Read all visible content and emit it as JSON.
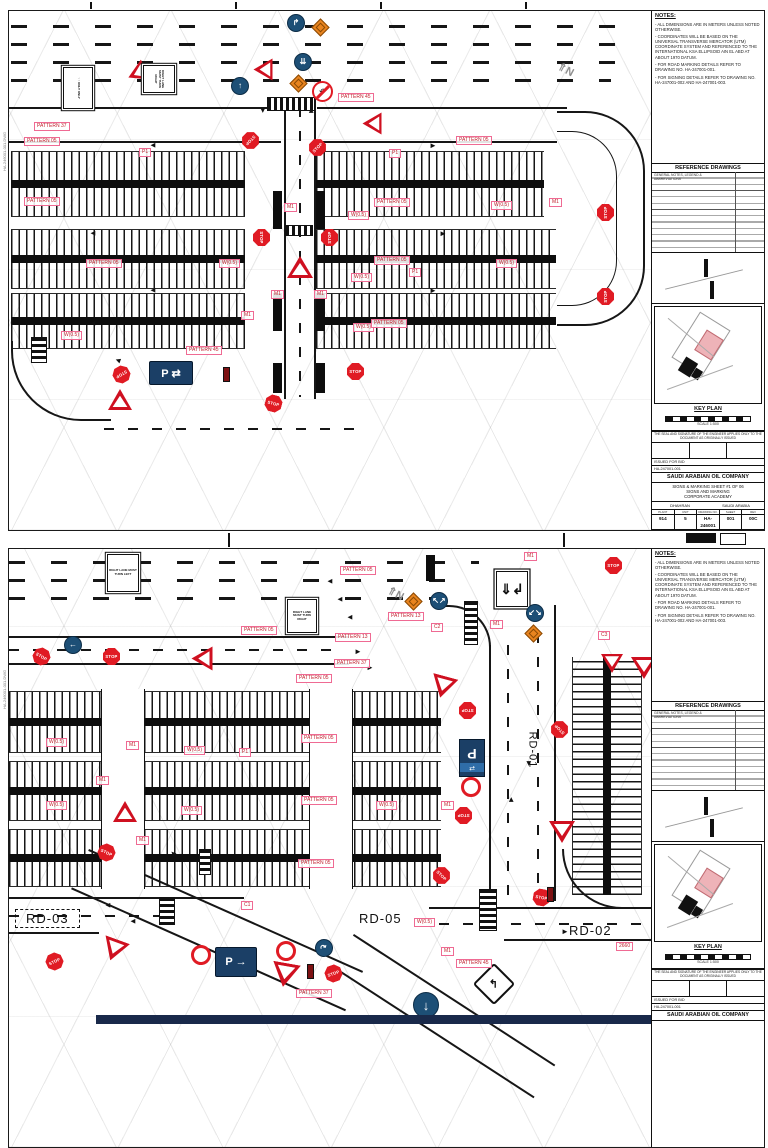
{
  "tb": {
    "notes_title": "NOTES:",
    "notes": [
      "ALL DIMENSIONS ARE IN METERS UNLESS NOTED OTHERWISE.",
      "COORDINATES WILL BE BASED ON THE UNIVERSAL TRANSVERSE MERCATOR (UTM) COORDINATE SYSTEM AND REFERENCED TO THE INTERNATIONAL KSA ELLIPSOID AIN EL ABD AT ABOUT 1970 DATUM.",
      "FOR ROAD MARKING DETAILS REFER TO DRAWING NO. HA-247001-001.",
      "FOR SIGNING DETAILS REFER TO DRAWING NO. HA-247001-002 AND HA-247001-003."
    ],
    "reference_title": "REFERENCE DRAWINGS",
    "ref_row1": "GENERAL NOTES, LEGEND & ABBREVIATIONS",
    "key_plan_label": "KEY PLAN",
    "scale_caption": "SCALE 1:500",
    "cert_note": "THE SEAL AND SIGNATURE OF THE ENGINEER APPLIES ONLY TO THE DOCUMENT AS ORIGINALLY ISSUED",
    "issue_row": "ISSUED FOR BID",
    "job_no": "HA-247001-001",
    "company": "SAUDI ARABIAN OIL COMPANY",
    "title1": "SIGNS & MARKING SHEET #1 OF 06",
    "title2": "SIGNS AND MARKING",
    "title3": "CORPORATE ACADEMY",
    "loc1": "DHAHRAN",
    "loc2": "SAUDI ARABIA",
    "num_labels": [
      "PLANT",
      "UNIT",
      "DRAWING NO.",
      "SHEET",
      "REV"
    ],
    "num_row": [
      "914",
      "5",
      "HA-246001",
      "001",
      "00C"
    ],
    "margin_text": "HA-246001-001.DWG"
  },
  "sheets": [
    {
      "labels": [
        {
          "t": "PATTERN 37",
          "x": 25,
          "y": 111
        },
        {
          "t": "PATTERN 05",
          "x": 15,
          "y": 126
        },
        {
          "t": "P1",
          "x": 130,
          "y": 137
        },
        {
          "t": "PATTERN 05",
          "x": 447,
          "y": 125
        },
        {
          "t": "P1",
          "x": 380,
          "y": 138
        },
        {
          "t": "PATTERN 05",
          "x": 15,
          "y": 186
        },
        {
          "t": "PATTERN 05",
          "x": 365,
          "y": 187
        },
        {
          "t": "W(0.5)",
          "x": 339,
          "y": 200
        },
        {
          "t": "W(0.5)",
          "x": 482,
          "y": 190
        },
        {
          "t": "M1",
          "x": 275,
          "y": 192
        },
        {
          "t": "W(0.5)",
          "x": 210,
          "y": 248
        },
        {
          "t": "PATTERN 05",
          "x": 77,
          "y": 248
        },
        {
          "t": "PATTERN 05",
          "x": 365,
          "y": 245
        },
        {
          "t": "W(0.5)",
          "x": 342,
          "y": 262
        },
        {
          "t": "W(0.5)",
          "x": 487,
          "y": 248
        },
        {
          "t": "P1",
          "x": 400,
          "y": 257
        },
        {
          "t": "M1",
          "x": 262,
          "y": 279
        },
        {
          "t": "M1",
          "x": 305,
          "y": 279
        },
        {
          "t": "W(0.5)",
          "x": 344,
          "y": 312
        },
        {
          "t": "PATTERN 05",
          "x": 362,
          "y": 308
        },
        {
          "t": "M1",
          "x": 232,
          "y": 300
        },
        {
          "t": "W(0.5)",
          "x": 52,
          "y": 320
        },
        {
          "t": "PATTERN 45",
          "x": 177,
          "y": 335
        },
        {
          "t": "PATTERN 45",
          "x": 329,
          "y": 82
        },
        {
          "t": "M1",
          "x": 540,
          "y": 187
        }
      ],
      "road_labels": [],
      "signs": [
        {
          "k": "sqsign",
          "x": 48,
          "y": 62,
          "w": 42,
          "h": 30,
          "r": 90,
          "t": "↑ ↑ ONLY  ONLY"
        },
        {
          "k": "tri",
          "x": 117,
          "y": 53,
          "r": -115
        },
        {
          "k": "sqsign",
          "x": 136,
          "y": 52,
          "w": 28,
          "h": 32,
          "r": 90,
          "t": "RIGHT LANE MUST TURN RIGHT"
        },
        {
          "k": "bluec",
          "x": 222,
          "y": 66,
          "g": "↑"
        },
        {
          "k": "bluec",
          "x": 278,
          "y": 3,
          "g": "↱"
        },
        {
          "k": "diam",
          "x": 305,
          "y": 10
        },
        {
          "k": "bluec",
          "x": 285,
          "y": 42,
          "g": "⇊"
        },
        {
          "k": "diam",
          "x": 283,
          "y": 66
        },
        {
          "k": "noturn",
          "x": 303,
          "y": 70,
          "g": "↶"
        },
        {
          "k": "tri",
          "x": 243,
          "y": 49,
          "r": -90
        },
        {
          "k": "tri",
          "x": 352,
          "y": 103,
          "r": -90
        },
        {
          "k": "north",
          "x": 548,
          "y": 52,
          "g": "⇑N"
        },
        {
          "k": "stop",
          "x": 233,
          "y": 121,
          "r": 135
        },
        {
          "k": "stop",
          "x": 300,
          "y": 128,
          "r": -45
        },
        {
          "k": "stop",
          "x": 244,
          "y": 218,
          "r": 90
        },
        {
          "k": "stop",
          "x": 312,
          "y": 218,
          "r": -90
        },
        {
          "k": "tri",
          "x": 278,
          "y": 245,
          "w": 26
        },
        {
          "k": "stop",
          "x": 104,
          "y": 355,
          "r": 150
        },
        {
          "k": "tri",
          "x": 99,
          "y": 378,
          "w": 24
        },
        {
          "k": "bluerect",
          "x": 140,
          "y": 350,
          "w": 44,
          "h": 24,
          "t": "P ⇄"
        },
        {
          "k": "darkbar",
          "x": 214,
          "y": 356
        },
        {
          "k": "stop",
          "x": 256,
          "y": 384,
          "r": 15
        },
        {
          "k": "stop",
          "x": 338,
          "y": 352
        },
        {
          "k": "stop",
          "x": 588,
          "y": 193,
          "r": -90
        },
        {
          "k": "stop",
          "x": 588,
          "y": 277,
          "r": -90
        },
        {
          "k": "arr",
          "x": 140,
          "y": 130,
          "r": 180
        },
        {
          "k": "arr",
          "x": 420,
          "y": 130
        },
        {
          "k": "arr",
          "x": 80,
          "y": 218,
          "r": 180
        },
        {
          "k": "arr",
          "x": 430,
          "y": 218
        },
        {
          "k": "arr",
          "x": 140,
          "y": 275,
          "r": 180
        },
        {
          "k": "arr",
          "x": 420,
          "y": 275
        },
        {
          "k": "arr",
          "x": 80,
          "y": 308,
          "r": 180
        },
        {
          "k": "arr",
          "x": 470,
          "y": 308
        },
        {
          "k": "arr",
          "x": 105,
          "y": 345,
          "r": 200
        },
        {
          "k": "arr",
          "x": 250,
          "y": 95,
          "r": 90
        },
        {
          "k": "arr",
          "x": 298,
          "y": 95,
          "r": -90
        }
      ]
    },
    {
      "labels": [
        {
          "t": "M1",
          "x": 515,
          "y": 3
        },
        {
          "t": "PATTERN 05",
          "x": 331,
          "y": 17
        },
        {
          "t": "PATTERN 13",
          "x": 379,
          "y": 63
        },
        {
          "t": "C2",
          "x": 422,
          "y": 74
        },
        {
          "t": "M1",
          "x": 481,
          "y": 71
        },
        {
          "t": "PATTERN 13",
          "x": 326,
          "y": 84
        },
        {
          "t": "PATTERN 37",
          "x": 325,
          "y": 110
        },
        {
          "t": "C3",
          "x": 589,
          "y": 82
        },
        {
          "t": "PATTERN 05",
          "x": 232,
          "y": 77
        },
        {
          "t": "PATTERN 05",
          "x": 287,
          "y": 125
        },
        {
          "t": "W(0.5)",
          "x": 37,
          "y": 189
        },
        {
          "t": "M1",
          "x": 117,
          "y": 192
        },
        {
          "t": "PATTERN 05",
          "x": 292,
          "y": 185
        },
        {
          "t": "W(0.5)",
          "x": 175,
          "y": 197
        },
        {
          "t": "P1",
          "x": 230,
          "y": 199
        },
        {
          "t": "W(0.5)",
          "x": 37,
          "y": 252
        },
        {
          "t": "M1",
          "x": 87,
          "y": 227
        },
        {
          "t": "W(0.5)",
          "x": 172,
          "y": 257
        },
        {
          "t": "PATTERN 05",
          "x": 292,
          "y": 247
        },
        {
          "t": "W(0.5)",
          "x": 367,
          "y": 252
        },
        {
          "t": "M1",
          "x": 432,
          "y": 252
        },
        {
          "t": "M1",
          "x": 127,
          "y": 287
        },
        {
          "t": "PATTERN 05",
          "x": 289,
          "y": 310
        },
        {
          "t": "C1",
          "x": 232,
          "y": 352
        },
        {
          "t": "W(0.5)",
          "x": 405,
          "y": 369
        },
        {
          "t": "M1",
          "x": 432,
          "y": 398
        },
        {
          "t": "PATTERN 45",
          "x": 447,
          "y": 410
        },
        {
          "t": "PATTERN 37",
          "x": 287,
          "y": 440
        },
        {
          "t": "2660",
          "x": 607,
          "y": 393
        }
      ],
      "road_labels": [
        {
          "t": "RD-01",
          "x": 505,
          "y": 195,
          "r": 90,
          "fs": 11
        },
        {
          "t": "RD-02",
          "x": 560,
          "y": 374,
          "fs": 13
        },
        {
          "t": "RD-03",
          "x": 6,
          "y": 360,
          "fs": 13,
          "box": 1
        },
        {
          "t": "RD-05",
          "x": 350,
          "y": 362,
          "fs": 13
        }
      ],
      "signs": [
        {
          "k": "sqsign",
          "x": 98,
          "y": 5,
          "w": 32,
          "h": 38,
          "t": "RIGHT LANE MUST TURN LEFT"
        },
        {
          "k": "sqsign",
          "x": 278,
          "y": 50,
          "w": 30,
          "h": 34,
          "t": "RIGHT LANE MUST TURN RIGHT"
        },
        {
          "k": "sqg",
          "x": 487,
          "y": 22,
          "w": 32,
          "h": 36,
          "g": "⇓↲"
        },
        {
          "k": "bluec",
          "x": 421,
          "y": 43,
          "g": "↖↗"
        },
        {
          "k": "diam",
          "x": 398,
          "y": 46
        },
        {
          "k": "bluec",
          "x": 517,
          "y": 55,
          "g": "↙↘"
        },
        {
          "k": "diam",
          "x": 518,
          "y": 78
        },
        {
          "k": "north",
          "x": 378,
          "y": 38,
          "g": "⇑N",
          "big": 1
        },
        {
          "k": "stop",
          "x": 596,
          "y": 8
        },
        {
          "k": "tri",
          "x": 592,
          "y": 105,
          "r": 180,
          "w": 22
        },
        {
          "k": "tri",
          "x": 622,
          "y": 108,
          "r": 180,
          "w": 26
        },
        {
          "k": "bluec",
          "x": 55,
          "y": 87,
          "g": "←"
        },
        {
          "k": "stop",
          "x": 24,
          "y": 99,
          "r": 30
        },
        {
          "k": "stop",
          "x": 94,
          "y": 99
        },
        {
          "k": "tri",
          "x": 181,
          "y": 99,
          "r": -90,
          "w": 24
        },
        {
          "k": "stop",
          "x": 450,
          "y": 153,
          "r": 180
        },
        {
          "k": "stop",
          "x": 542,
          "y": 172,
          "r": -135
        },
        {
          "k": "tri",
          "x": 421,
          "y": 127,
          "r": 195,
          "w": 26
        },
        {
          "k": "prect",
          "x": 450,
          "y": 190,
          "r": 180
        },
        {
          "k": "p30",
          "x": 452,
          "y": 228,
          "r": 90
        },
        {
          "k": "stop",
          "x": 446,
          "y": 258,
          "r": 180
        },
        {
          "k": "tri",
          "x": 540,
          "y": 272,
          "r": 180,
          "w": 26
        },
        {
          "k": "stop",
          "x": 89,
          "y": 295,
          "r": 25
        },
        {
          "k": "tri",
          "x": 104,
          "y": 252,
          "w": 24
        },
        {
          "k": "stop",
          "x": 424,
          "y": 318,
          "r": 45
        },
        {
          "k": "stop",
          "x": 524,
          "y": 340,
          "r": 10
        },
        {
          "k": "darkbar",
          "x": 538,
          "y": 338
        },
        {
          "k": "stop",
          "x": 37,
          "y": 404,
          "r": -25
        },
        {
          "k": "tri",
          "x": 92,
          "y": 390,
          "r": 200,
          "w": 26
        },
        {
          "k": "p30",
          "x": 182,
          "y": 396,
          "r": 80
        },
        {
          "k": "bluerect",
          "x": 206,
          "y": 398,
          "w": 42,
          "h": 30,
          "t": "P →"
        },
        {
          "k": "p30",
          "x": 267,
          "y": 392,
          "r": 100
        },
        {
          "k": "tri",
          "x": 262,
          "y": 414,
          "r": 190,
          "w": 28
        },
        {
          "k": "bluec",
          "x": 306,
          "y": 390,
          "g": "↷",
          "r": -30
        },
        {
          "k": "darkbar",
          "x": 298,
          "y": 415
        },
        {
          "k": "stop",
          "x": 316,
          "y": 416,
          "r": -20
        },
        {
          "k": "bluec",
          "x": 404,
          "y": 443,
          "g": "↓",
          "big": 1
        },
        {
          "k": "wdiamond",
          "x": 470,
          "y": 420,
          "g": "↰"
        },
        {
          "k": "arr",
          "x": 317,
          "y": 28,
          "r": 180
        },
        {
          "k": "arr",
          "x": 327,
          "y": 46,
          "r": 180
        },
        {
          "k": "arr",
          "x": 337,
          "y": 64,
          "r": 180
        },
        {
          "k": "arr",
          "x": 345,
          "y": 98
        },
        {
          "k": "arr",
          "x": 357,
          "y": 114
        },
        {
          "k": "arr",
          "x": 552,
          "y": 378
        },
        {
          "k": "arr",
          "x": 120,
          "y": 368,
          "r": 180
        },
        {
          "k": "arr",
          "x": 498,
          "y": 246,
          "r": -90
        },
        {
          "k": "arr",
          "x": 516,
          "y": 210,
          "r": 90
        },
        {
          "k": "arr",
          "x": 160,
          "y": 300,
          "r": 225
        },
        {
          "k": "arr",
          "x": 95,
          "y": 352,
          "r": 180
        }
      ]
    }
  ]
}
